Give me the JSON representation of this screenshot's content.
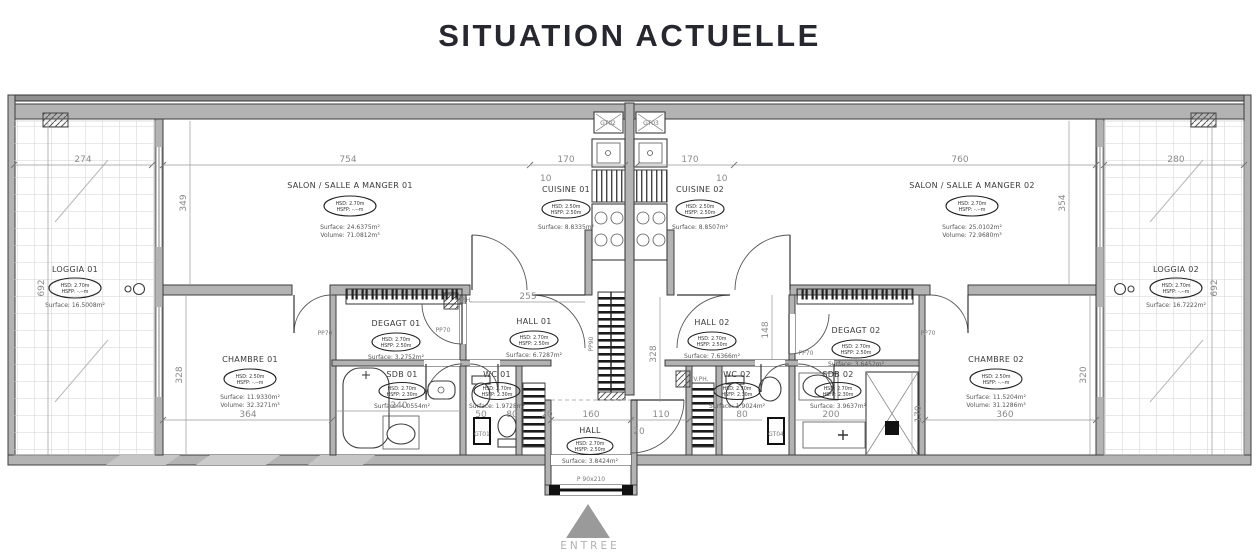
{
  "title": "SITUATION ACTUELLE",
  "rooms": {
    "loggia1": {
      "name": "LOGGIA 01",
      "hsd": "HSD: 2.70m",
      "hsfp": "HSFP: -.--m",
      "surface": "Surface: 16.5008m²"
    },
    "salon1": {
      "name": "SALON / SALLE A MANGER 01",
      "hsd": "HSD: 2.70m",
      "hsfp": "HSFP: -.--m",
      "surface": "Surface: 24.6375m²",
      "volume": "Volume: 71.0812m³"
    },
    "cuisine1": {
      "name": "CUISINE 01",
      "hsd": "HSD: 2.50m",
      "hsfp": "HSFP: 2.50m",
      "surface": "Surface: 8.8335m²"
    },
    "cuisine2": {
      "name": "CUISINE 02",
      "hsd": "HSD: 2.50m",
      "hsfp": "HSFP: 2.50m",
      "surface": "Surface: 8.8507m²"
    },
    "salon2": {
      "name": "SALON / SALLE A MANGER 02",
      "hsd": "HSD: 2.70m",
      "hsfp": "HSFP: -.--m",
      "surface": "Surface: 25.0102m²",
      "volume": "Volume: 72.9680m³"
    },
    "loggia2": {
      "name": "LOGGIA 02",
      "hsd": "HSD: 2.70m",
      "hsfp": "HSFP: -.--m",
      "surface": "Surface: 16.7222m²"
    },
    "chambre1": {
      "name": "CHAMBRE 01",
      "hsd": "HSD: 2.50m",
      "hsfp": "HSFP: -.--m",
      "surface": "Surface: 11.9330m²",
      "volume": "Volume: 32.3271m³"
    },
    "degagt1": {
      "name": "DEGAGT 01",
      "hsd": "HSD: 2.70m",
      "hsfp": "HSFP: 2.50m",
      "surface": "Surface: 3.2752m²"
    },
    "hall1": {
      "name": "HALL 01",
      "hsd": "HSD: 2.70m",
      "hsfp": "HSFP: 2.50m",
      "surface": "Surface: 6.7287m²"
    },
    "sdb1": {
      "name": "SDB 01",
      "hsd": "HSD: 2.70m",
      "hsfp": "HSFP: 2.30m",
      "surface": "Surface: 4.0554m²"
    },
    "wc1": {
      "name": "WC 01",
      "hsd": "HSD: 2.70m",
      "hsfp": "HSFP: 2.30m",
      "surface": "Surface: 1.9728m²"
    },
    "hall_entree": {
      "name": "HALL",
      "hsd": "HSD: 2.70m",
      "hsfp": "HSFP: 2.50m",
      "surface": "Surface: 3.8424m²"
    },
    "hall2": {
      "name": "HALL 02",
      "hsd": "HSD: 2.70m",
      "hsfp": "HSFP: 2.50m",
      "surface": "Surface: 7.6366m²"
    },
    "degagt2": {
      "name": "DEGAGT 02",
      "hsd": "HSD: 2.70m",
      "hsfp": "HSFP: 2.50m",
      "surface": "Surface: 3.6452m²"
    },
    "wc2": {
      "name": "WC 02",
      "hsd": "HSD: 2.70m",
      "hsfp": "HSFP: 2.30m",
      "surface": "Surface: 1.9024m²"
    },
    "sdb2": {
      "name": "SDB 02",
      "hsd": "HSD: 2.70m",
      "hsfp": "HSFP: 2.30m",
      "surface": "Surface: 3.9637m²"
    },
    "chambre2": {
      "name": "CHAMBRE 02",
      "hsd": "HSD: 2.50m",
      "hsfp": "HSFP: -.--m",
      "surface": "Surface: 11.5204m²",
      "volume": "Volume: 31.1286m³"
    }
  },
  "dimensions": {
    "top": {
      "loggia1": "274",
      "salon1": "754",
      "cuisine1": "170",
      "cuisine2": "170",
      "salon2": "760",
      "loggia2": "280",
      "offset1": "10",
      "offset2": "10"
    },
    "left": {
      "salon": "349",
      "loggia": "692",
      "chambre": "328"
    },
    "right": {
      "salon": "354",
      "loggia": "692",
      "chambre": "320"
    },
    "middle": {
      "hall1_width": "255",
      "stair": "328",
      "hall2_height": "148",
      "shower": "170"
    },
    "bottom": {
      "chambre1": "364",
      "sdb1": "240",
      "wc1_a": "50",
      "wc1_b": "80",
      "hall_a": "20",
      "hall_b": "160",
      "hall_c": "20",
      "hall_d": "110",
      "wc2": "80",
      "sdb2": "200",
      "chambre2": "360"
    }
  },
  "labels": {
    "pp70_chambre1": "PP70",
    "pp70_degagt1": "PP70",
    "pp70_degagt2": "PP70",
    "pp70_chambre2": "PP70",
    "pp90": "PP90",
    "vph1": "V.P.H.",
    "vph2": "V.PH.",
    "gt01": "GT01",
    "gt02": "GT02",
    "gt03": "GT03",
    "gt04": "GT04",
    "entrance_door": "P 90x210",
    "entree": "ENTREE"
  }
}
